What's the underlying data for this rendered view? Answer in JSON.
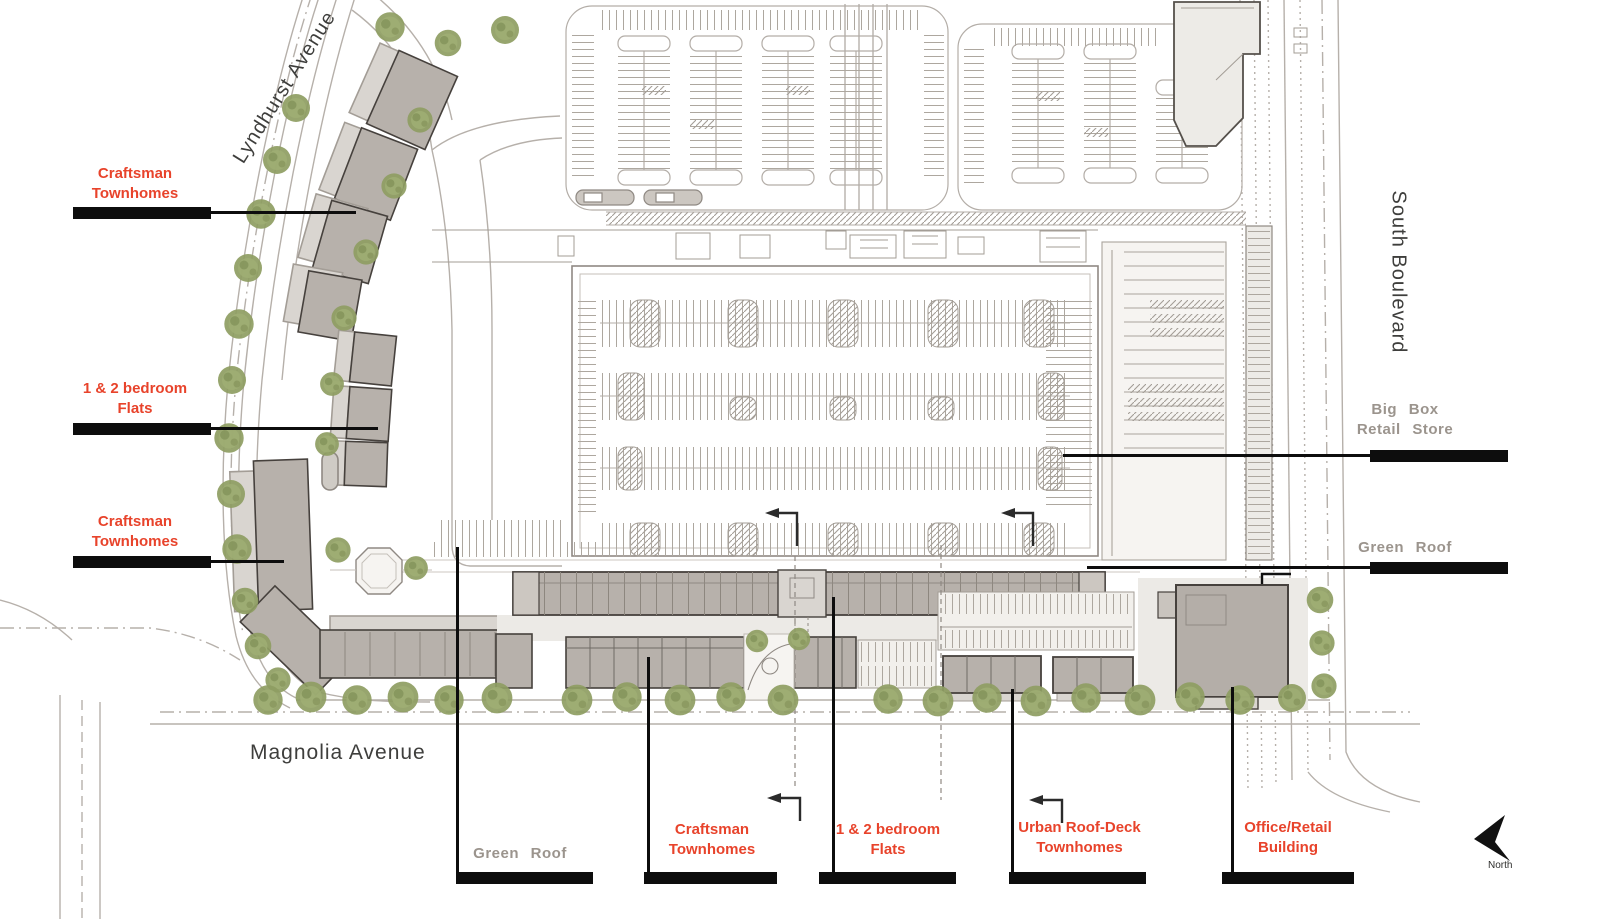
{
  "plan": {
    "streets": {
      "lyndhurst": "Lyndhurst Avenue",
      "south_boulevard": "South Boulevard",
      "magnolia": "Magnolia Avenue"
    },
    "callouts": {
      "craftsman_upper": "Craftsman\nTownhomes",
      "flats_left": "1 & 2 bedroom\nFlats",
      "craftsman_lower": "Craftsman\nTownhomes",
      "big_box": "Big Box\nRetail Store",
      "green_roof_right": "Green Roof",
      "green_roof_bottom": "Green Roof",
      "craftsman_bottom": "Craftsman\nTownhomes",
      "flats_bottom": "1 & 2 bedroom\nFlats",
      "urban_roof_deck": "Urban Roof-Deck\nTownhomes",
      "office_retail": "Office/Retail\nBuilding"
    },
    "compass": {
      "north": "North"
    },
    "colors": {
      "callout_red": "#e8432b",
      "callout_gray": "#9b948d",
      "street_text": "#3e3e3c",
      "tree_green": "#8e9d62",
      "building_fill": "#b7b1ab",
      "building_outline": "#46413d",
      "leader_black": "#0d0d0d",
      "plan_line": "#aaa49d"
    }
  }
}
